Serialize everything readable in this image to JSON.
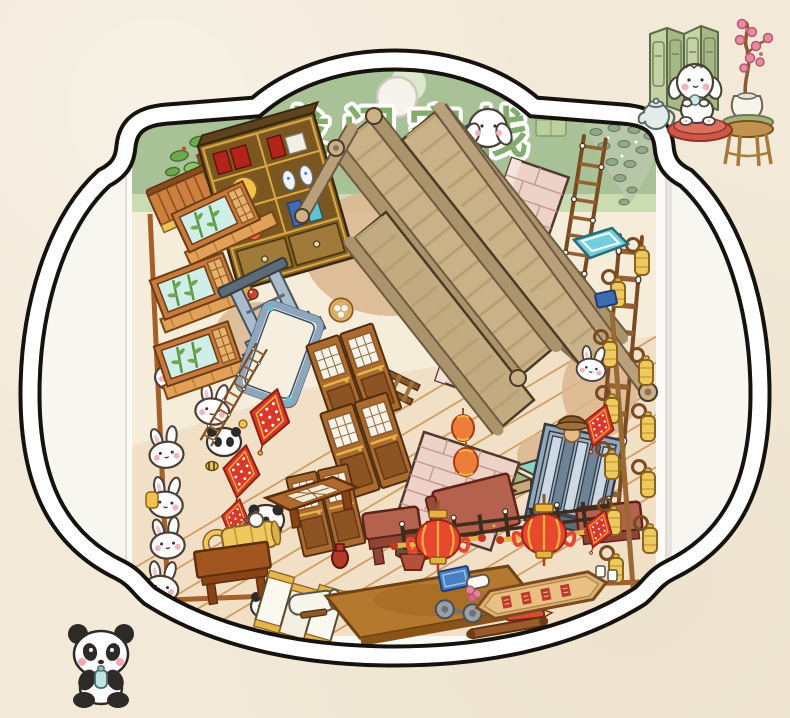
{
  "product": {
    "type_hint": "sticker-sheet-package-photo",
    "header": {
      "title": "龙门客栈",
      "hang_hole": true
    }
  },
  "palette": {
    "page_bg": "#f2e9d8",
    "photo_bg": "#f8f6f1",
    "frame_line": "#16120e",
    "frame_band": "#ffffff",
    "header_green": "#a9c197",
    "header_light": "#ccdcb2",
    "title_green": "#82ad6b",
    "sheet_bg": "#f5ecd9",
    "floor": "#f1dfc6",
    "plank_line": "#cf9f63",
    "roof_tan": "#c9b287",
    "tube_tan": "#ab946c",
    "brick_pink": "#edd2c7",
    "banner_red": "#d8392a",
    "lantern_red": "#e8472e",
    "gold": "#eec95e",
    "teal": "#6fcfdd",
    "blue_gray": "#93a7b7",
    "leaf_green": "#6da84e",
    "step_mint": "#9fb47f",
    "wood_mid": "#b5712f",
    "panda_black": "#2e2a28",
    "cheek_pink": "#f2a9b4"
  },
  "stickers": [
    "roof-ridge-strips",
    "roof-tile-tube-chains",
    "bookshelf-cabinet",
    "bonsai-shelf",
    "tiled-eave",
    "bamboo-windows",
    "gate-stand",
    "mirror-frame",
    "lattice-doors",
    "red-diamond-banners",
    "staircase",
    "brick-wall",
    "brick-tower",
    "shuttered-gate",
    "big-red-lanterns",
    "small-orange-lanterns",
    "golden-lock-charms",
    "wooden-ladders",
    "hanging-vine",
    "puppy-with-teal-board",
    "steamer-basket",
    "dumpling-plate",
    "white-rabbits",
    "pandas",
    "bee",
    "mushrooms",
    "fence-railing",
    "red-stools",
    "lattice-table",
    "golden-barrel-lock",
    "wooden-table",
    "wooden-platform",
    "folding-screen-panels",
    "paper-roll",
    "fire-brazier",
    "red-vase",
    "white-teapot",
    "blue-tray",
    "pink-flowers",
    "inn-signboard-red-characters",
    "dumbbell",
    "red-pencil",
    "wooden-scroll",
    "teal-window",
    "blue-book",
    "straw-hat-figure",
    "white-cups"
  ],
  "corner_decorations": {
    "top_right": [
      "folding-screen",
      "puppy-with-teacup",
      "red-cushion",
      "teapot",
      "plum-blossom-vase",
      "wooden-stool"
    ],
    "bottom_left": [
      "panda-with-drink"
    ]
  }
}
